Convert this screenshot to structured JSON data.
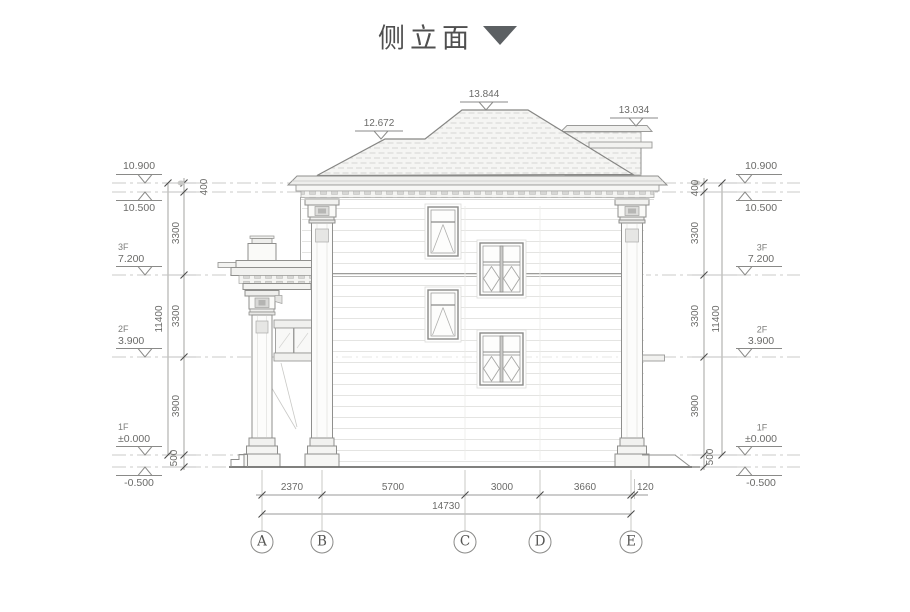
{
  "title": {
    "text": "侧立面"
  },
  "colors": {
    "line": "#8a8a88",
    "text": "#6b6b69",
    "accent_triangle": "#5c6063"
  },
  "roof_marks": {
    "left": "12.672",
    "main": "13.844",
    "right": "13.034"
  },
  "levels": [
    {
      "floor": "",
      "value": "10.900"
    },
    {
      "floor": "",
      "value": "10.500"
    },
    {
      "floor": "3F",
      "value": "7.200"
    },
    {
      "floor": "2F",
      "value": "3.900"
    },
    {
      "floor": "1F",
      "value": "±0.000"
    },
    {
      "floor": "",
      "value": "-0.500"
    }
  ],
  "vdims": {
    "segments": [
      "400",
      "3300",
      "3300",
      "3900",
      "500"
    ],
    "overall": "11400"
  },
  "hdims": {
    "segments": [
      "2370",
      "5700",
      "3000",
      "3660",
      "120"
    ],
    "overall": "14730"
  },
  "grid": {
    "labels": [
      "A",
      "B",
      "C",
      "D",
      "E"
    ]
  }
}
